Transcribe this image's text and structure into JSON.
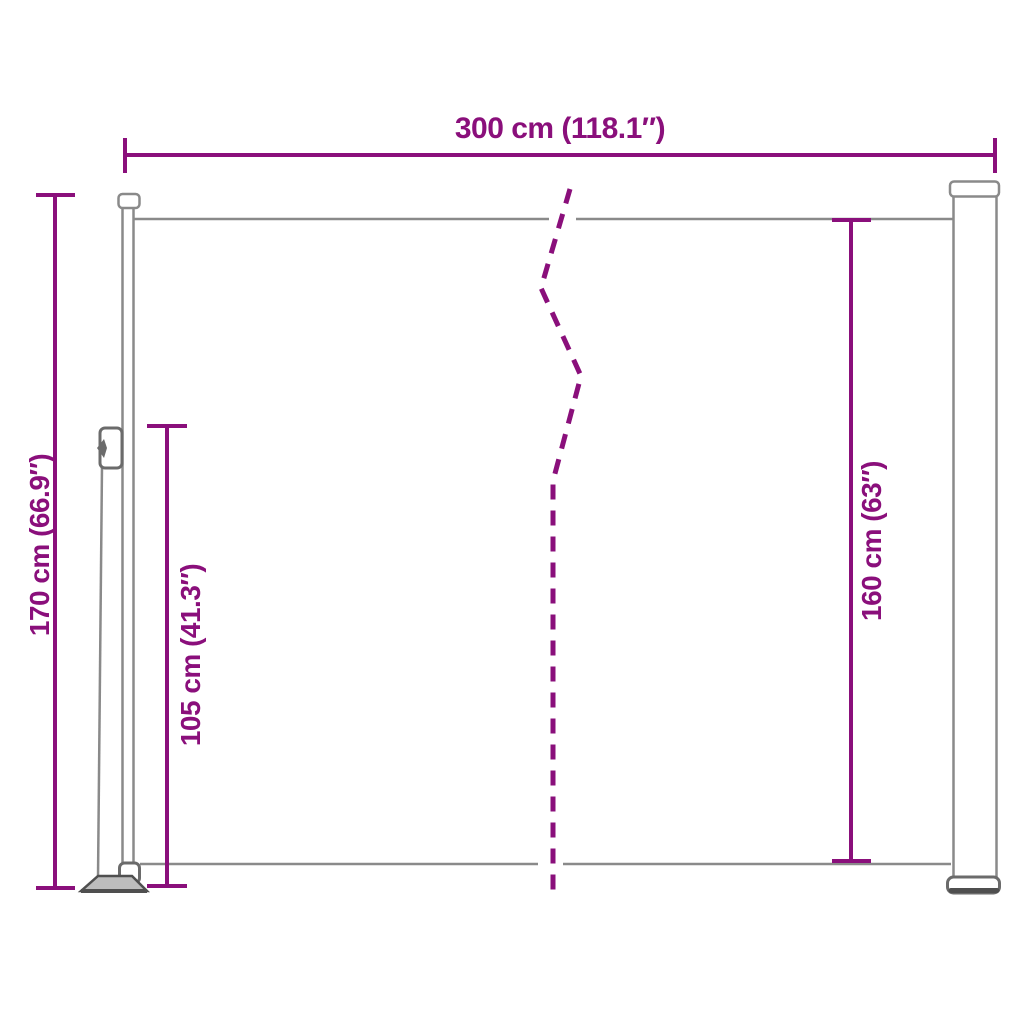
{
  "colors": {
    "accent": "#8A0F7B",
    "outline_gray": "#8A8A8A",
    "structure_gray": "#6B6B6B",
    "dark_gray": "#4F4F4F",
    "plate_fill": "#BDBDBD",
    "background": "#FFFFFF"
  },
  "diagram": {
    "type": "product-dimension-diagram",
    "product": "retractable-side-awning",
    "dimensions": {
      "width_top": {
        "label": "300 cm (118.1″)",
        "value_cm": 300,
        "value_in": 118.1
      },
      "height_left_total": {
        "label": "170 cm (66.9″)",
        "value_cm": 170,
        "value_in": 66.9
      },
      "height_inner_left": {
        "label": "105 cm (41.3″)",
        "value_cm": 105,
        "value_in": 41.3
      },
      "height_right_fabric": {
        "label": "160 cm (63″)",
        "value_cm": 160,
        "value_in": 63
      }
    }
  }
}
